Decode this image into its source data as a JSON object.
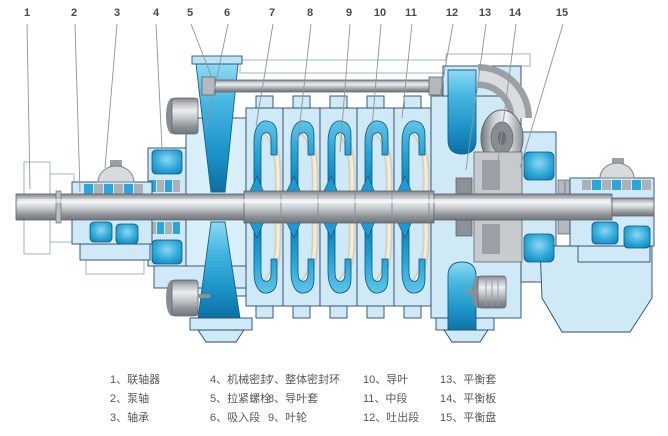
{
  "figure": {
    "type": "pump-cross-section-diagram",
    "callouts": [
      "1",
      "2",
      "3",
      "4",
      "5",
      "6",
      "7",
      "8",
      "9",
      "10",
      "11",
      "12",
      "13",
      "14",
      "15"
    ],
    "legend": {
      "columns": [
        {
          "items": [
            "1、联轴器",
            "2、泵轴",
            "3、轴承"
          ]
        },
        {
          "items": [
            "4、机械密封",
            "5、拉紧螺栓",
            "6、吸入段"
          ]
        },
        {
          "items": [
            "7、整体密封环",
            "8、导叶套",
            "9、叶轮"
          ]
        },
        {
          "items": [
            "10、导叶",
            "11、中段",
            "12、吐出段"
          ]
        },
        {
          "items": [
            "13、平衡套",
            "14、平衡板",
            "15、平衡盘"
          ]
        }
      ]
    },
    "colors": {
      "casing_light_blue": "#cfe9f6",
      "suction_light_blue": "#d9effa",
      "water_vivid_blue": "#1d9ad4",
      "deep_blue": "#0f7fb4",
      "metal_gray": "#b5babf",
      "outline_navy": "#2a4a6b",
      "background": "#ffffff"
    }
  }
}
